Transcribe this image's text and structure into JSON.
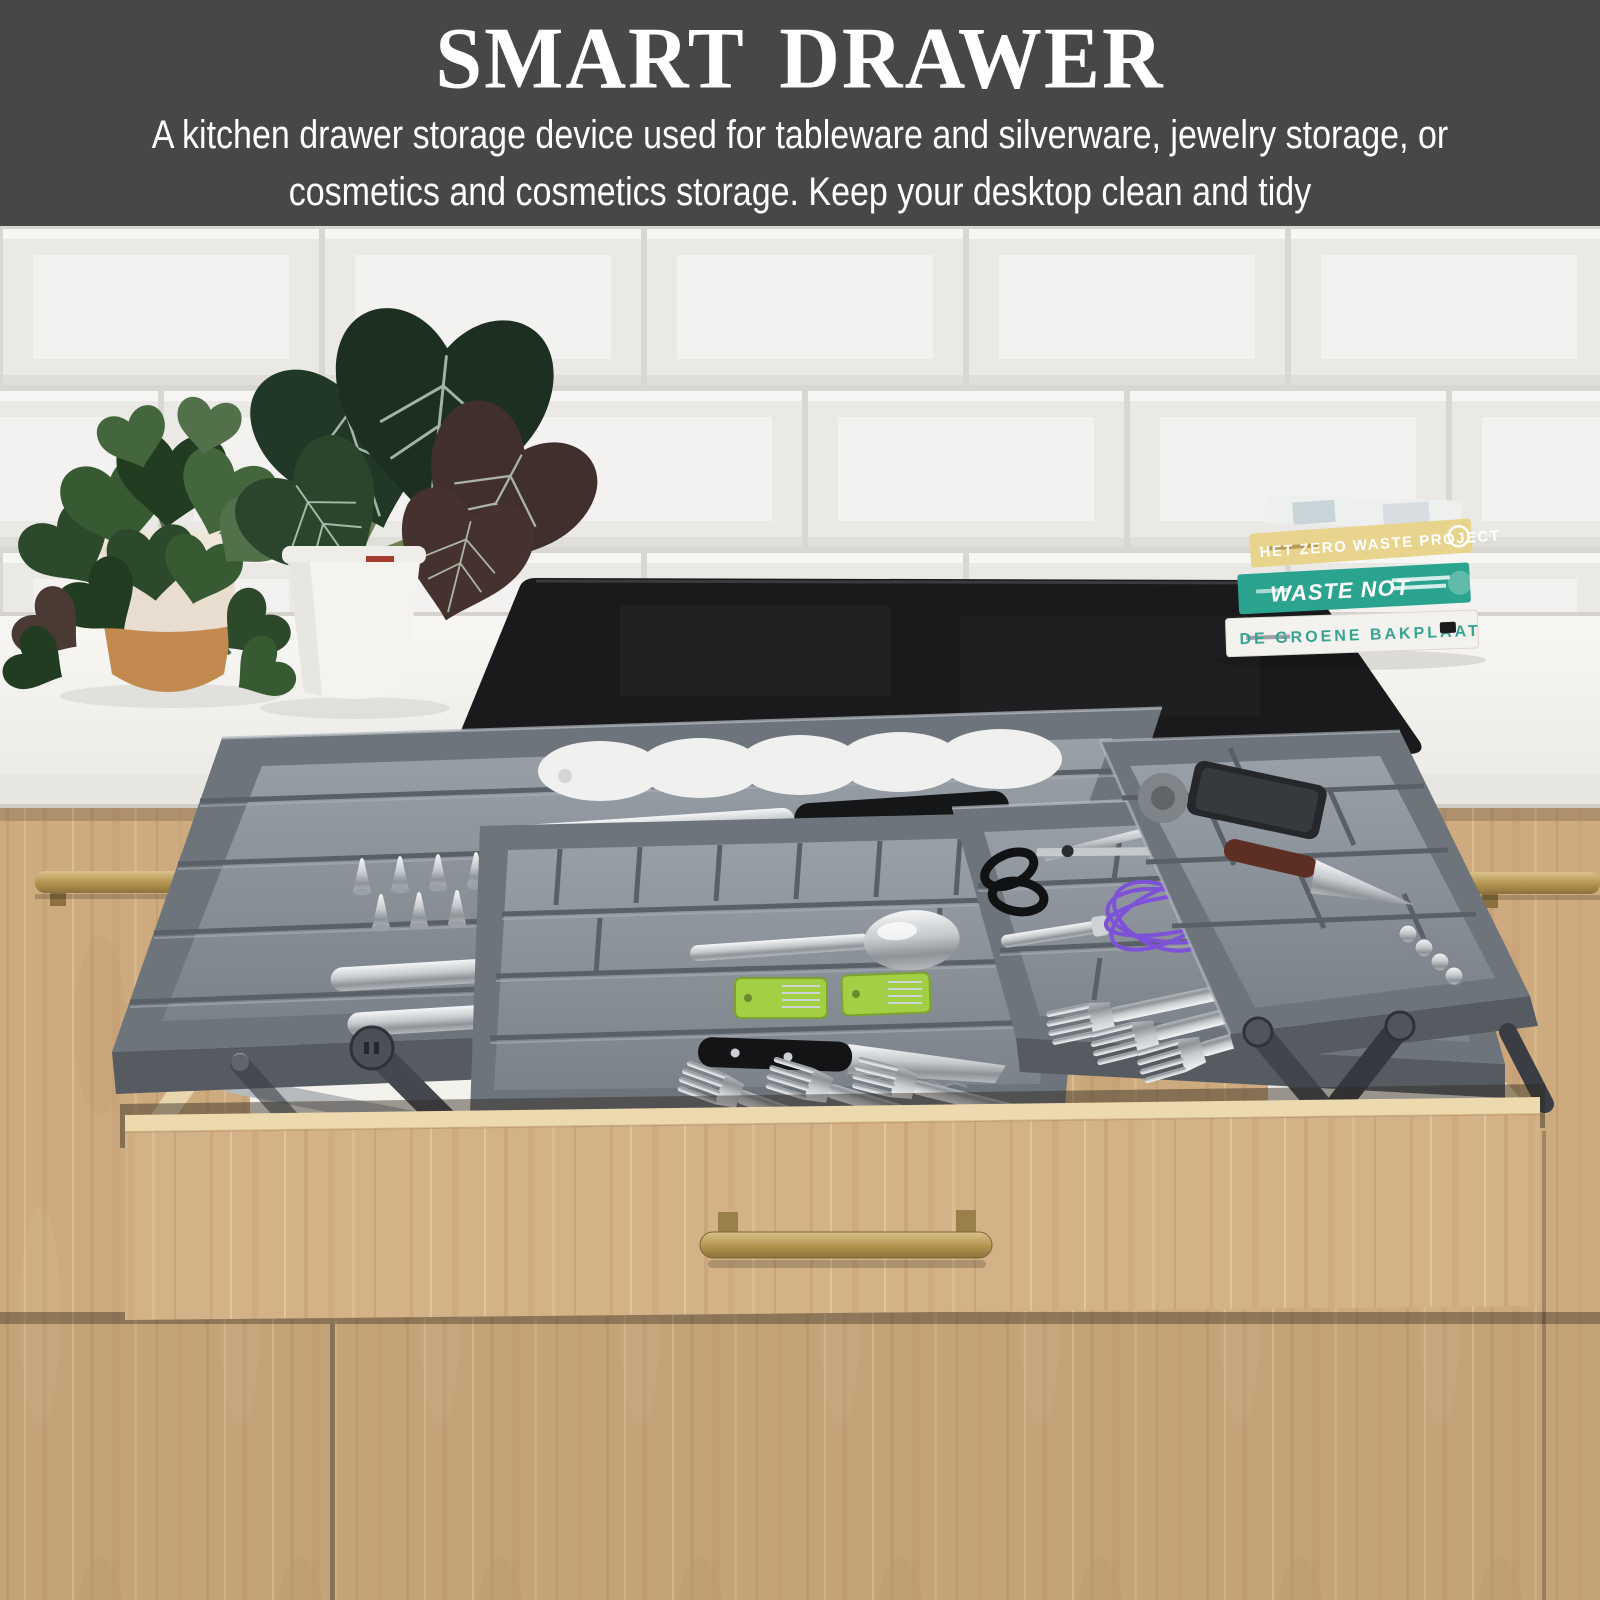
{
  "banner": {
    "title": "SMART DRAWER",
    "subtitle": "A kitchen drawer storage device used for tableware and silverware, jewelry storage, or cosmetics and cosmetics storage. Keep your desktop clean and tidy"
  },
  "scene": {
    "books": [
      {
        "title": "HET ZERO WASTE PROJECT"
      },
      {
        "title": "WASTE NOT"
      },
      {
        "title": "DE GROENE BAKPLAAT"
      }
    ],
    "colors": {
      "banner_bg": "#474747",
      "banner_text": "#ffffff",
      "tile": "#f3f2f0",
      "grout": "#d9d7d3",
      "counter": "#f6f5f2",
      "cooktop": "#1a1a1c",
      "wood": "#cdab7f",
      "wood_front": "#d4b287",
      "brass": "#b99a63",
      "tray": "#6e747b",
      "tray_floor": "#8d939a",
      "book_yellow": "#e8d48c",
      "book_teal": "#2aa48e",
      "book_white": "#f4f2ee",
      "whisk_purple": "#7e52d8",
      "sharpener_green": "#a3cf44"
    }
  }
}
